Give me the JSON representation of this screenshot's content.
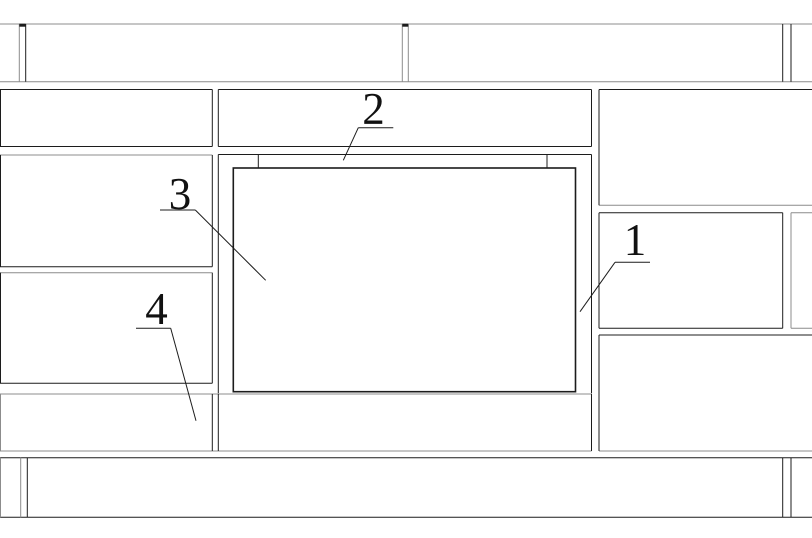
{
  "drawing": {
    "width": 812,
    "height": 538,
    "background": "#ffffff",
    "colors": {
      "k": "#1c1c1c",
      "g": "#8c8c8c"
    },
    "label_font_size": 45,
    "label_color": "#111111",
    "hlines": [
      {
        "name": "course-a-top",
        "y": 24,
        "x1": 0,
        "x2": 812,
        "c": "g"
      },
      {
        "name": "course-a-bottom",
        "y": 81.7,
        "x1": 0,
        "x2": 812,
        "c": "g"
      },
      {
        "name": "panel-b1-top",
        "y": 89.5,
        "x1": 0,
        "x2": 212.3,
        "c": "k"
      },
      {
        "name": "panel-b1-bottom",
        "y": 146.5,
        "x1": 0,
        "x2": 212.3,
        "c": "k"
      },
      {
        "name": "lintel-panel-top",
        "y": 89.5,
        "x1": 218.3,
        "x2": 591.5,
        "c": "k"
      },
      {
        "name": "lintel-panel-bottom",
        "y": 146.5,
        "x1": 218.3,
        "x2": 591.5,
        "c": "k"
      },
      {
        "name": "panel-r1-top",
        "y": 89.5,
        "x1": 599,
        "x2": 812,
        "c": "k"
      },
      {
        "name": "panel-r1-bottom",
        "y": 205.3,
        "x1": 599,
        "x2": 812,
        "c": "g"
      },
      {
        "name": "panel-r2-top",
        "y": 212.7,
        "x1": 599,
        "x2": 782.7,
        "c": "k"
      },
      {
        "name": "panel-r2-bottom",
        "y": 328.3,
        "x1": 599,
        "x2": 782.7,
        "c": "k"
      },
      {
        "name": "panel-r2b-top",
        "y": 212.7,
        "x1": 791,
        "x2": 812,
        "c": "g"
      },
      {
        "name": "panel-r2b-bottom",
        "y": 328.3,
        "x1": 791,
        "x2": 812,
        "c": "g"
      },
      {
        "name": "panel-r3-top",
        "y": 335,
        "x1": 599,
        "x2": 812,
        "c": "k"
      },
      {
        "name": "panel-r3-bottom",
        "y": 451,
        "x1": 599,
        "x2": 812,
        "c": "g"
      },
      {
        "name": "panel-c1-top",
        "y": 155,
        "x1": 0,
        "x2": 212.3,
        "c": "g"
      },
      {
        "name": "panel-c1-bottom",
        "y": 266.7,
        "x1": 0,
        "x2": 212.3,
        "c": "k"
      },
      {
        "name": "panel-d1-top",
        "y": 272.7,
        "x1": 0,
        "x2": 212.3,
        "c": "g"
      },
      {
        "name": "panel-d1-bottom",
        "y": 383.3,
        "x1": 0,
        "x2": 212.3,
        "c": "k"
      },
      {
        "name": "sill-course-top",
        "y": 394,
        "x1": 0,
        "x2": 591.5,
        "c": "g"
      },
      {
        "name": "sill-course-bottom",
        "y": 451,
        "x1": 0,
        "x2": 591.5,
        "c": "g"
      },
      {
        "name": "base-band-top",
        "y": 457.7,
        "x1": 0,
        "x2": 812,
        "c": "k"
      },
      {
        "name": "base-band-bottom",
        "y": 517.3,
        "x1": 0,
        "x2": 812,
        "c": "k"
      },
      {
        "name": "opening-head-line",
        "y": 154.5,
        "x1": 218.3,
        "x2": 591.5,
        "c": "k"
      }
    ],
    "vlines": [
      {
        "name": "joint-a1",
        "x": 19.3,
        "y1": 24,
        "y2": 81.7,
        "c": "g"
      },
      {
        "name": "joint-a2",
        "x": 25.7,
        "y1": 24,
        "y2": 81.7,
        "c": "k"
      },
      {
        "name": "joint-a3",
        "x": 402.3,
        "y1": 24,
        "y2": 81.7,
        "c": "g"
      },
      {
        "name": "joint-a4",
        "x": 408.3,
        "y1": 24,
        "y2": 81.7,
        "c": "g"
      },
      {
        "name": "joint-a5",
        "x": 782.7,
        "y1": 24,
        "y2": 81.7,
        "c": "k"
      },
      {
        "name": "joint-a6",
        "x": 791,
        "y1": 24,
        "y2": 81.7,
        "c": "k"
      },
      {
        "name": "panel-b1-left",
        "x": 0.5,
        "y1": 89.5,
        "y2": 146.5,
        "c": "k"
      },
      {
        "name": "panel-b1-right",
        "x": 212.3,
        "y1": 89.5,
        "y2": 146.5,
        "c": "k"
      },
      {
        "name": "lintel-panel-left",
        "x": 218.3,
        "y1": 89.5,
        "y2": 146.5,
        "c": "k"
      },
      {
        "name": "lintel-panel-right",
        "x": 591.5,
        "y1": 89.5,
        "y2": 146.5,
        "c": "k"
      },
      {
        "name": "panel-r1-left",
        "x": 599,
        "y1": 89.5,
        "y2": 205.3,
        "c": "k"
      },
      {
        "name": "panel-r2-left",
        "x": 599,
        "y1": 212.7,
        "y2": 328.3,
        "c": "k"
      },
      {
        "name": "panel-r2-right",
        "x": 782.7,
        "y1": 212.7,
        "y2": 328.3,
        "c": "k"
      },
      {
        "name": "panel-r2b-left",
        "x": 791,
        "y1": 212.7,
        "y2": 328.3,
        "c": "g"
      },
      {
        "name": "panel-r3-left",
        "x": 599,
        "y1": 335,
        "y2": 451,
        "c": "k"
      },
      {
        "name": "panel-c1-left",
        "x": 0.5,
        "y1": 155,
        "y2": 266.7,
        "c": "k"
      },
      {
        "name": "panel-c1-right",
        "x": 212.3,
        "y1": 155,
        "y2": 266.7,
        "c": "k"
      },
      {
        "name": "panel-d1-left",
        "x": 0.5,
        "y1": 272.7,
        "y2": 383.3,
        "c": "k"
      },
      {
        "name": "panel-d1-right",
        "x": 212.3,
        "y1": 272.7,
        "y2": 383.3,
        "c": "k"
      },
      {
        "name": "sill-left-edge",
        "x": 0.5,
        "y1": 394,
        "y2": 451,
        "c": "g"
      },
      {
        "name": "sill-joint-left",
        "x": 212.3,
        "y1": 394,
        "y2": 451,
        "c": "k"
      },
      {
        "name": "sill-panel-left",
        "x": 218.3,
        "y1": 394,
        "y2": 451,
        "c": "k"
      },
      {
        "name": "sill-panel-right",
        "x": 591.5,
        "y1": 394,
        "y2": 451,
        "c": "k"
      },
      {
        "name": "base-left-edge",
        "x": 0.5,
        "y1": 457.7,
        "y2": 517.3,
        "c": "g"
      },
      {
        "name": "base-joint-1",
        "x": 20.7,
        "y1": 457.7,
        "y2": 517.3,
        "c": "g"
      },
      {
        "name": "base-joint-2",
        "x": 27.3,
        "y1": 457.7,
        "y2": 517.3,
        "c": "k"
      },
      {
        "name": "base-joint-3",
        "x": 782.7,
        "y1": 457.7,
        "y2": 517.3,
        "c": "k"
      },
      {
        "name": "base-joint-4",
        "x": 791,
        "y1": 457.7,
        "y2": 517.3,
        "c": "k"
      },
      {
        "name": "opening-jamb-left",
        "x": 218.3,
        "y1": 154.5,
        "y2": 393.3,
        "c": "k"
      },
      {
        "name": "opening-jamb-right",
        "x": 591.5,
        "y1": 154.5,
        "y2": 393.3,
        "c": "k"
      },
      {
        "name": "head-tick-left",
        "x": 258.3,
        "y1": 154.5,
        "y2": 168,
        "c": "k"
      },
      {
        "name": "head-tick-right",
        "x": 547,
        "y1": 154.5,
        "y2": 168,
        "c": "k"
      }
    ],
    "joint_ticks": [
      {
        "name": "course-a-joint-tick-1",
        "x1": 19.3,
        "x2": 25.7,
        "y": 25.2
      },
      {
        "name": "course-a-joint-tick-2",
        "x1": 402.3,
        "x2": 408.3,
        "y": 25.2
      }
    ],
    "window_frame": {
      "x": 233.3,
      "y": 168,
      "w": 342.2,
      "h": 223.7,
      "stroke_width": 1.6
    },
    "callouts": [
      {
        "label": "1",
        "x": 635,
        "y": 255,
        "underline": [
          615,
          262.3,
          650,
          262.3
        ],
        "leader": [
          615,
          262.3,
          580,
          311.7
        ]
      },
      {
        "label": "2",
        "x": 373.5,
        "y": 124,
        "underline": [
          358.3,
          127.7,
          393.3,
          127.7
        ],
        "leader": [
          358.3,
          127.7,
          343.3,
          160.3
        ]
      },
      {
        "label": "3",
        "x": 180,
        "y": 209,
        "underline": [
          160,
          210,
          195.3,
          210
        ],
        "leader": [
          195.3,
          210,
          265.7,
          280.3
        ]
      },
      {
        "label": "4",
        "x": 156.5,
        "y": 324,
        "underline": [
          136,
          328.3,
          170.7,
          328.3
        ],
        "leader": [
          170.7,
          328.3,
          196,
          420.7
        ]
      }
    ]
  }
}
